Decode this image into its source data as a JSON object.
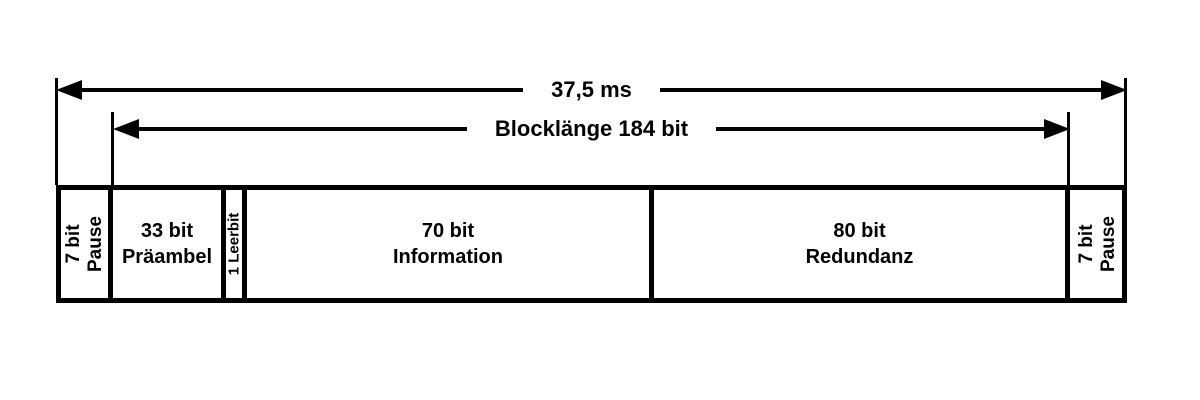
{
  "arrows": {
    "total": {
      "label": "37,5 ms"
    },
    "block": {
      "label": "Blocklänge 184 bit"
    }
  },
  "bar": {
    "segments": [
      {
        "line1": "7 bit",
        "line2": "Pause",
        "orientation": "vertical"
      },
      {
        "line1": "33 bit",
        "line2": "Präambel",
        "orientation": "horizontal"
      },
      {
        "line1": "1 Leerbit",
        "line2": "",
        "orientation": "vertical"
      },
      {
        "line1": "70 bit",
        "line2": "Information",
        "orientation": "horizontal"
      },
      {
        "line1": "80 bit",
        "line2": "Redundanz",
        "orientation": "horizontal"
      },
      {
        "line1": "7 bit",
        "line2": "Pause",
        "orientation": "vertical"
      }
    ]
  },
  "colors": {
    "ink": "#000000",
    "background": "#ffffff"
  }
}
